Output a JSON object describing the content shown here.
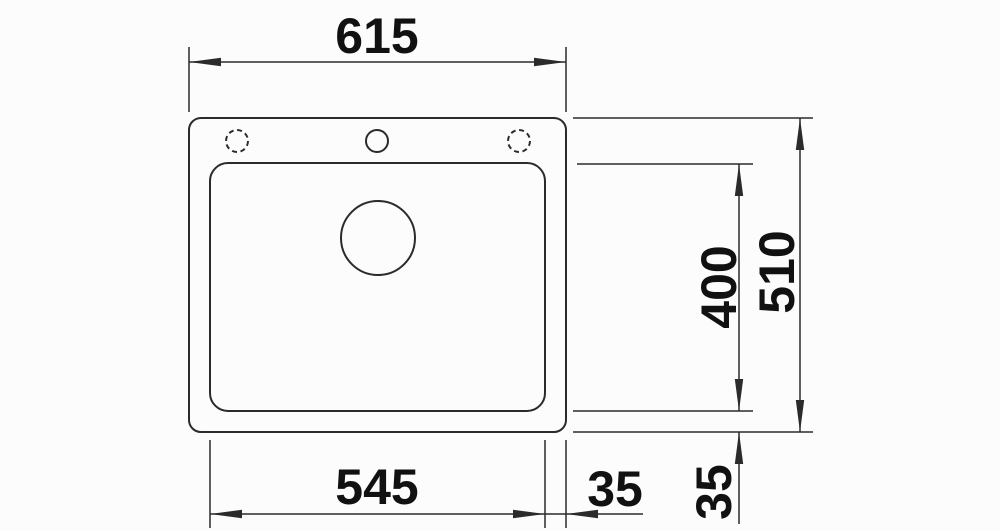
{
  "drawing": {
    "colors": {
      "background": "#fcfcfc",
      "line": "#2b2b2b",
      "text": "#111111"
    },
    "dimensions": {
      "overall_width": "615",
      "bowl_width": "545",
      "bowl_depth": "400",
      "overall_depth": "510",
      "edge_offset_right": "35",
      "edge_offset_bottom": "35"
    }
  }
}
